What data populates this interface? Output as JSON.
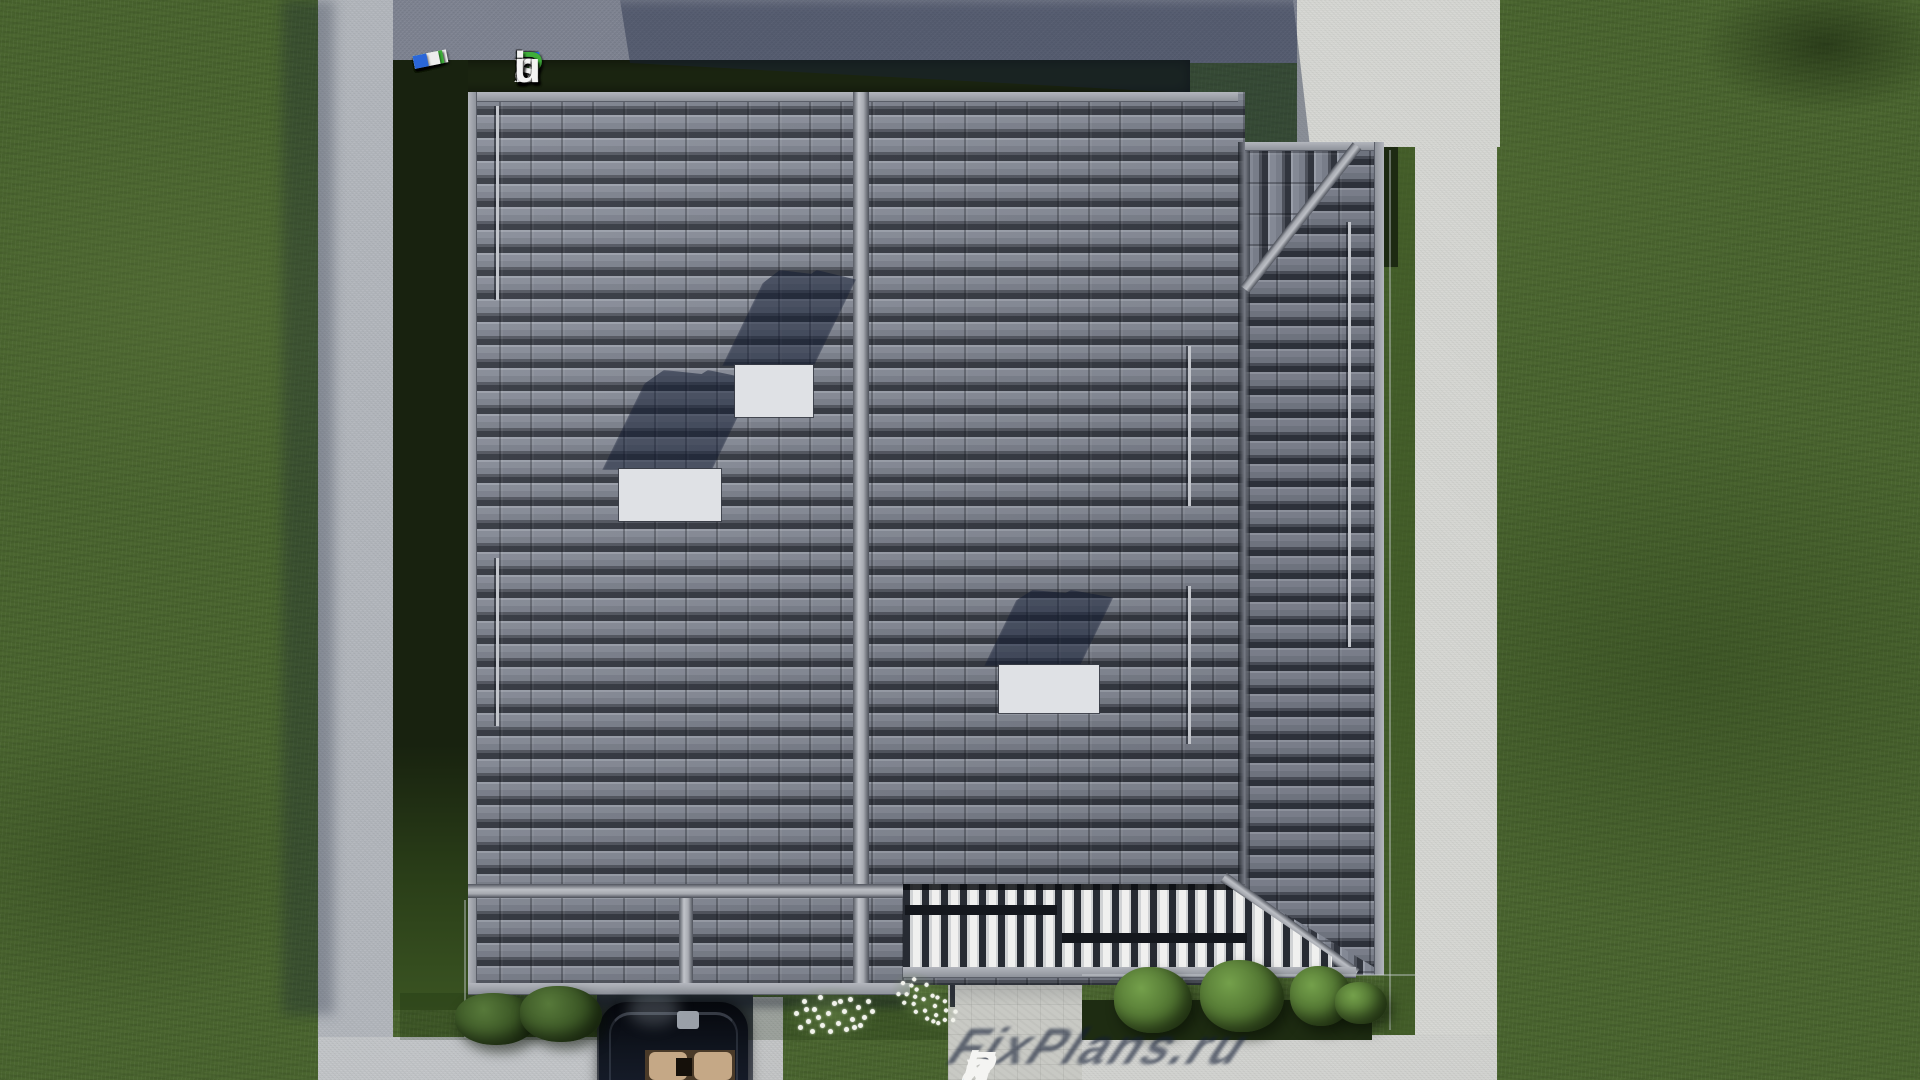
{
  "site": {
    "name": "FixPlans.ru",
    "logo_letters": [
      {
        "ch": "F",
        "color": "#2b6be0"
      },
      {
        "ch": "i",
        "color": "#f3f3f3"
      },
      {
        "ch": "x",
        "color": "#f3f3f3"
      },
      {
        "ch": "P",
        "color": "#3fae3a"
      },
      {
        "ch": "l",
        "color": "#f3f3f3"
      },
      {
        "ch": "a",
        "color": "#f3f3f3"
      },
      {
        "ch": "n",
        "color": "#f3f3f3"
      },
      {
        "ch": "s",
        "color": "#f3f3f3"
      },
      {
        "ch": ".",
        "color": "#2b6be0"
      },
      {
        "ch": "r",
        "color": "#f3f3f3"
      },
      {
        "ch": "u",
        "color": "#f3f3f3"
      }
    ],
    "watermark_letters": [
      {
        "ch": "F",
        "color": "#f4f4f2"
      },
      {
        "ch": "i",
        "color": "#f4f4f2"
      },
      {
        "ch": "x",
        "color": "#f4f4f2"
      },
      {
        "ch": "P",
        "color": "#f4f4f2"
      },
      {
        "ch": "l",
        "color": "#f4f4f2"
      },
      {
        "ch": "a",
        "color": "#f4f4f2"
      },
      {
        "ch": "n",
        "color": "#f4f4f2"
      },
      {
        "ch": "s",
        "color": "#f4f4f2"
      },
      {
        "ch": ".",
        "color": "#2aa4f0"
      },
      {
        "ch": "r",
        "color": "#f4f4f2"
      },
      {
        "ch": "u",
        "color": "#f4f4f2"
      }
    ],
    "tape_segments": [
      {
        "w": 22,
        "gap": 6,
        "color": "#ededed"
      },
      {
        "w": 12,
        "gap": 5,
        "color": "#ededed"
      },
      {
        "w": 13,
        "gap": 5,
        "color": "#2a66d9"
      },
      {
        "w": 26,
        "gap": 2,
        "color": "#ededed"
      },
      {
        "w": 34,
        "gap": 6,
        "color": "#ededed"
      },
      {
        "w": 30,
        "gap": 6,
        "color": "#ededed"
      },
      {
        "w": 12,
        "gap": 5,
        "color": "#ededed"
      },
      {
        "w": 30,
        "gap": 6,
        "color": "#3caf38"
      },
      {
        "w": 24,
        "gap": 4,
        "color": "#ededed"
      },
      {
        "w": 20,
        "gap": 4,
        "color": "#ededed"
      },
      {
        "w": 13,
        "gap": 4,
        "color": "#3caf38"
      },
      {
        "w": 26,
        "gap": 4,
        "color": "#ededed"
      },
      {
        "w": 14,
        "gap": 0,
        "color": "#2a66d9"
      }
    ]
  },
  "palette": {
    "grass": "#4a652f",
    "hedge": "#1b2511",
    "roof_tile_light": "#9ba0ab",
    "roof_tile_dark": "#32363f",
    "ridge_beam": "#b0b4bb",
    "path_left": "#b2b6bc",
    "road_top": "#7d8290",
    "concrete_white": "#d6d7d3",
    "pergola_slat": "#f0f0ef",
    "car_body": "#0a0e16",
    "car_seats": "#c5a886",
    "shadow_blue": "rgba(17,26,50,0.52)"
  },
  "scene": {
    "roof_vents": [
      {
        "x": 618,
        "y": 468,
        "w": 104,
        "h": 54
      },
      {
        "x": 734,
        "y": 364,
        "w": 80,
        "h": 54
      },
      {
        "x": 998,
        "y": 664,
        "w": 102,
        "h": 50
      }
    ],
    "vent_shadows": [
      {
        "x": 602,
        "y": 370,
        "w": 110,
        "h": 100
      },
      {
        "x": 722,
        "y": 270,
        "w": 92,
        "h": 96
      },
      {
        "x": 984,
        "y": 590,
        "w": 96,
        "h": 76
      }
    ],
    "gutter_pipes": [
      {
        "x": 494,
        "y": 106,
        "h": 194
      },
      {
        "x": 494,
        "y": 558,
        "h": 168
      },
      {
        "x": 1186,
        "y": 346,
        "h": 160
      },
      {
        "x": 1186,
        "y": 586,
        "h": 158
      },
      {
        "x": 1346,
        "y": 222,
        "h": 425
      }
    ],
    "bushes": [
      {
        "x": 455,
        "y": 993,
        "w": 82,
        "h": 52,
        "variant": "dark"
      },
      {
        "x": 520,
        "y": 986,
        "w": 82,
        "h": 56,
        "variant": "dark"
      },
      {
        "x": 1114,
        "y": 967,
        "w": 78,
        "h": 66,
        "variant": "light"
      },
      {
        "x": 1200,
        "y": 960,
        "w": 84,
        "h": 72,
        "variant": "light"
      },
      {
        "x": 1290,
        "y": 966,
        "w": 62,
        "h": 60,
        "variant": "light"
      },
      {
        "x": 1335,
        "y": 982,
        "w": 52,
        "h": 42,
        "variant": "light"
      }
    ],
    "flower_clusters": [
      {
        "x": 792,
        "y": 993,
        "scale": 1,
        "rot": 0
      },
      {
        "x": 884,
        "y": 981,
        "scale": 0.82,
        "rot": 38
      }
    ],
    "flower_dot_offsets": [
      [
        2,
        18
      ],
      [
        10,
        6
      ],
      [
        14,
        26
      ],
      [
        20,
        14
      ],
      [
        26,
        2
      ],
      [
        28,
        30
      ],
      [
        34,
        18
      ],
      [
        40,
        8
      ],
      [
        44,
        28
      ],
      [
        50,
        16
      ],
      [
        56,
        4
      ],
      [
        58,
        24
      ],
      [
        64,
        12
      ],
      [
        70,
        22
      ],
      [
        74,
        6
      ],
      [
        78,
        16
      ],
      [
        6,
        32
      ],
      [
        18,
        36
      ],
      [
        36,
        36
      ],
      [
        52,
        34
      ],
      [
        66,
        30
      ],
      [
        24,
        22
      ],
      [
        46,
        6
      ],
      [
        60,
        32
      ],
      [
        12,
        14
      ]
    ]
  }
}
